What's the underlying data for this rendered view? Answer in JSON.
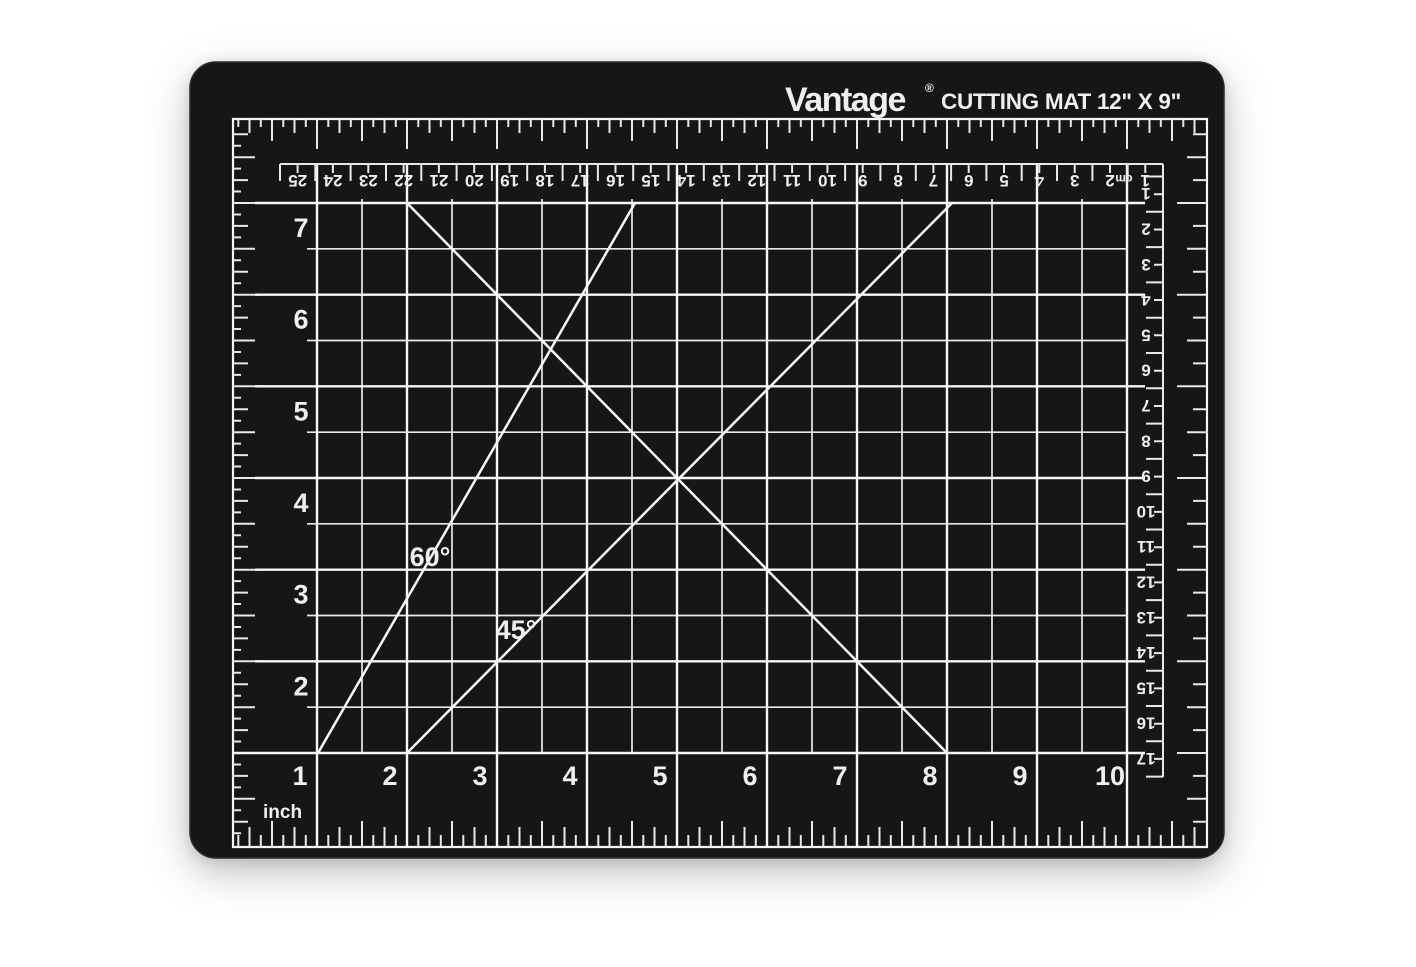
{
  "product": {
    "brand": "Vantage",
    "registered_mark": "®",
    "title": "CUTTING MAT 12\" X 9\""
  },
  "mat": {
    "colors": {
      "surface": "#161616",
      "edge_highlight": "#2a2a2a",
      "markings": "#e9e9e9",
      "markings_bright": "#f7f7f7",
      "background": "#ffffff"
    },
    "angle_labels": {
      "sixty": "60°",
      "forty_five": "45°"
    },
    "unit_label": "inch",
    "cm_unit_label": "cm",
    "rulers": {
      "top_cm": {
        "orientation": "rotated-180",
        "numbers": [
          25,
          24,
          23,
          22,
          21,
          20,
          19,
          18,
          17,
          16,
          15,
          14,
          13,
          12,
          11,
          10,
          9,
          8,
          7,
          6,
          5,
          4,
          3,
          2,
          1
        ]
      },
      "right_cm": {
        "orientation": "rotated-180",
        "numbers": [
          1,
          2,
          3,
          4,
          5,
          6,
          7,
          8,
          9,
          10,
          11,
          12,
          13,
          14,
          15,
          16,
          17
        ]
      },
      "left_inch": {
        "orientation": "upright",
        "numbers": [
          7,
          6,
          5,
          4,
          3,
          2
        ]
      },
      "bottom_inch": {
        "orientation": "upright",
        "numbers": [
          1,
          2,
          3,
          4,
          5,
          6,
          7,
          8,
          9,
          10
        ]
      }
    }
  }
}
